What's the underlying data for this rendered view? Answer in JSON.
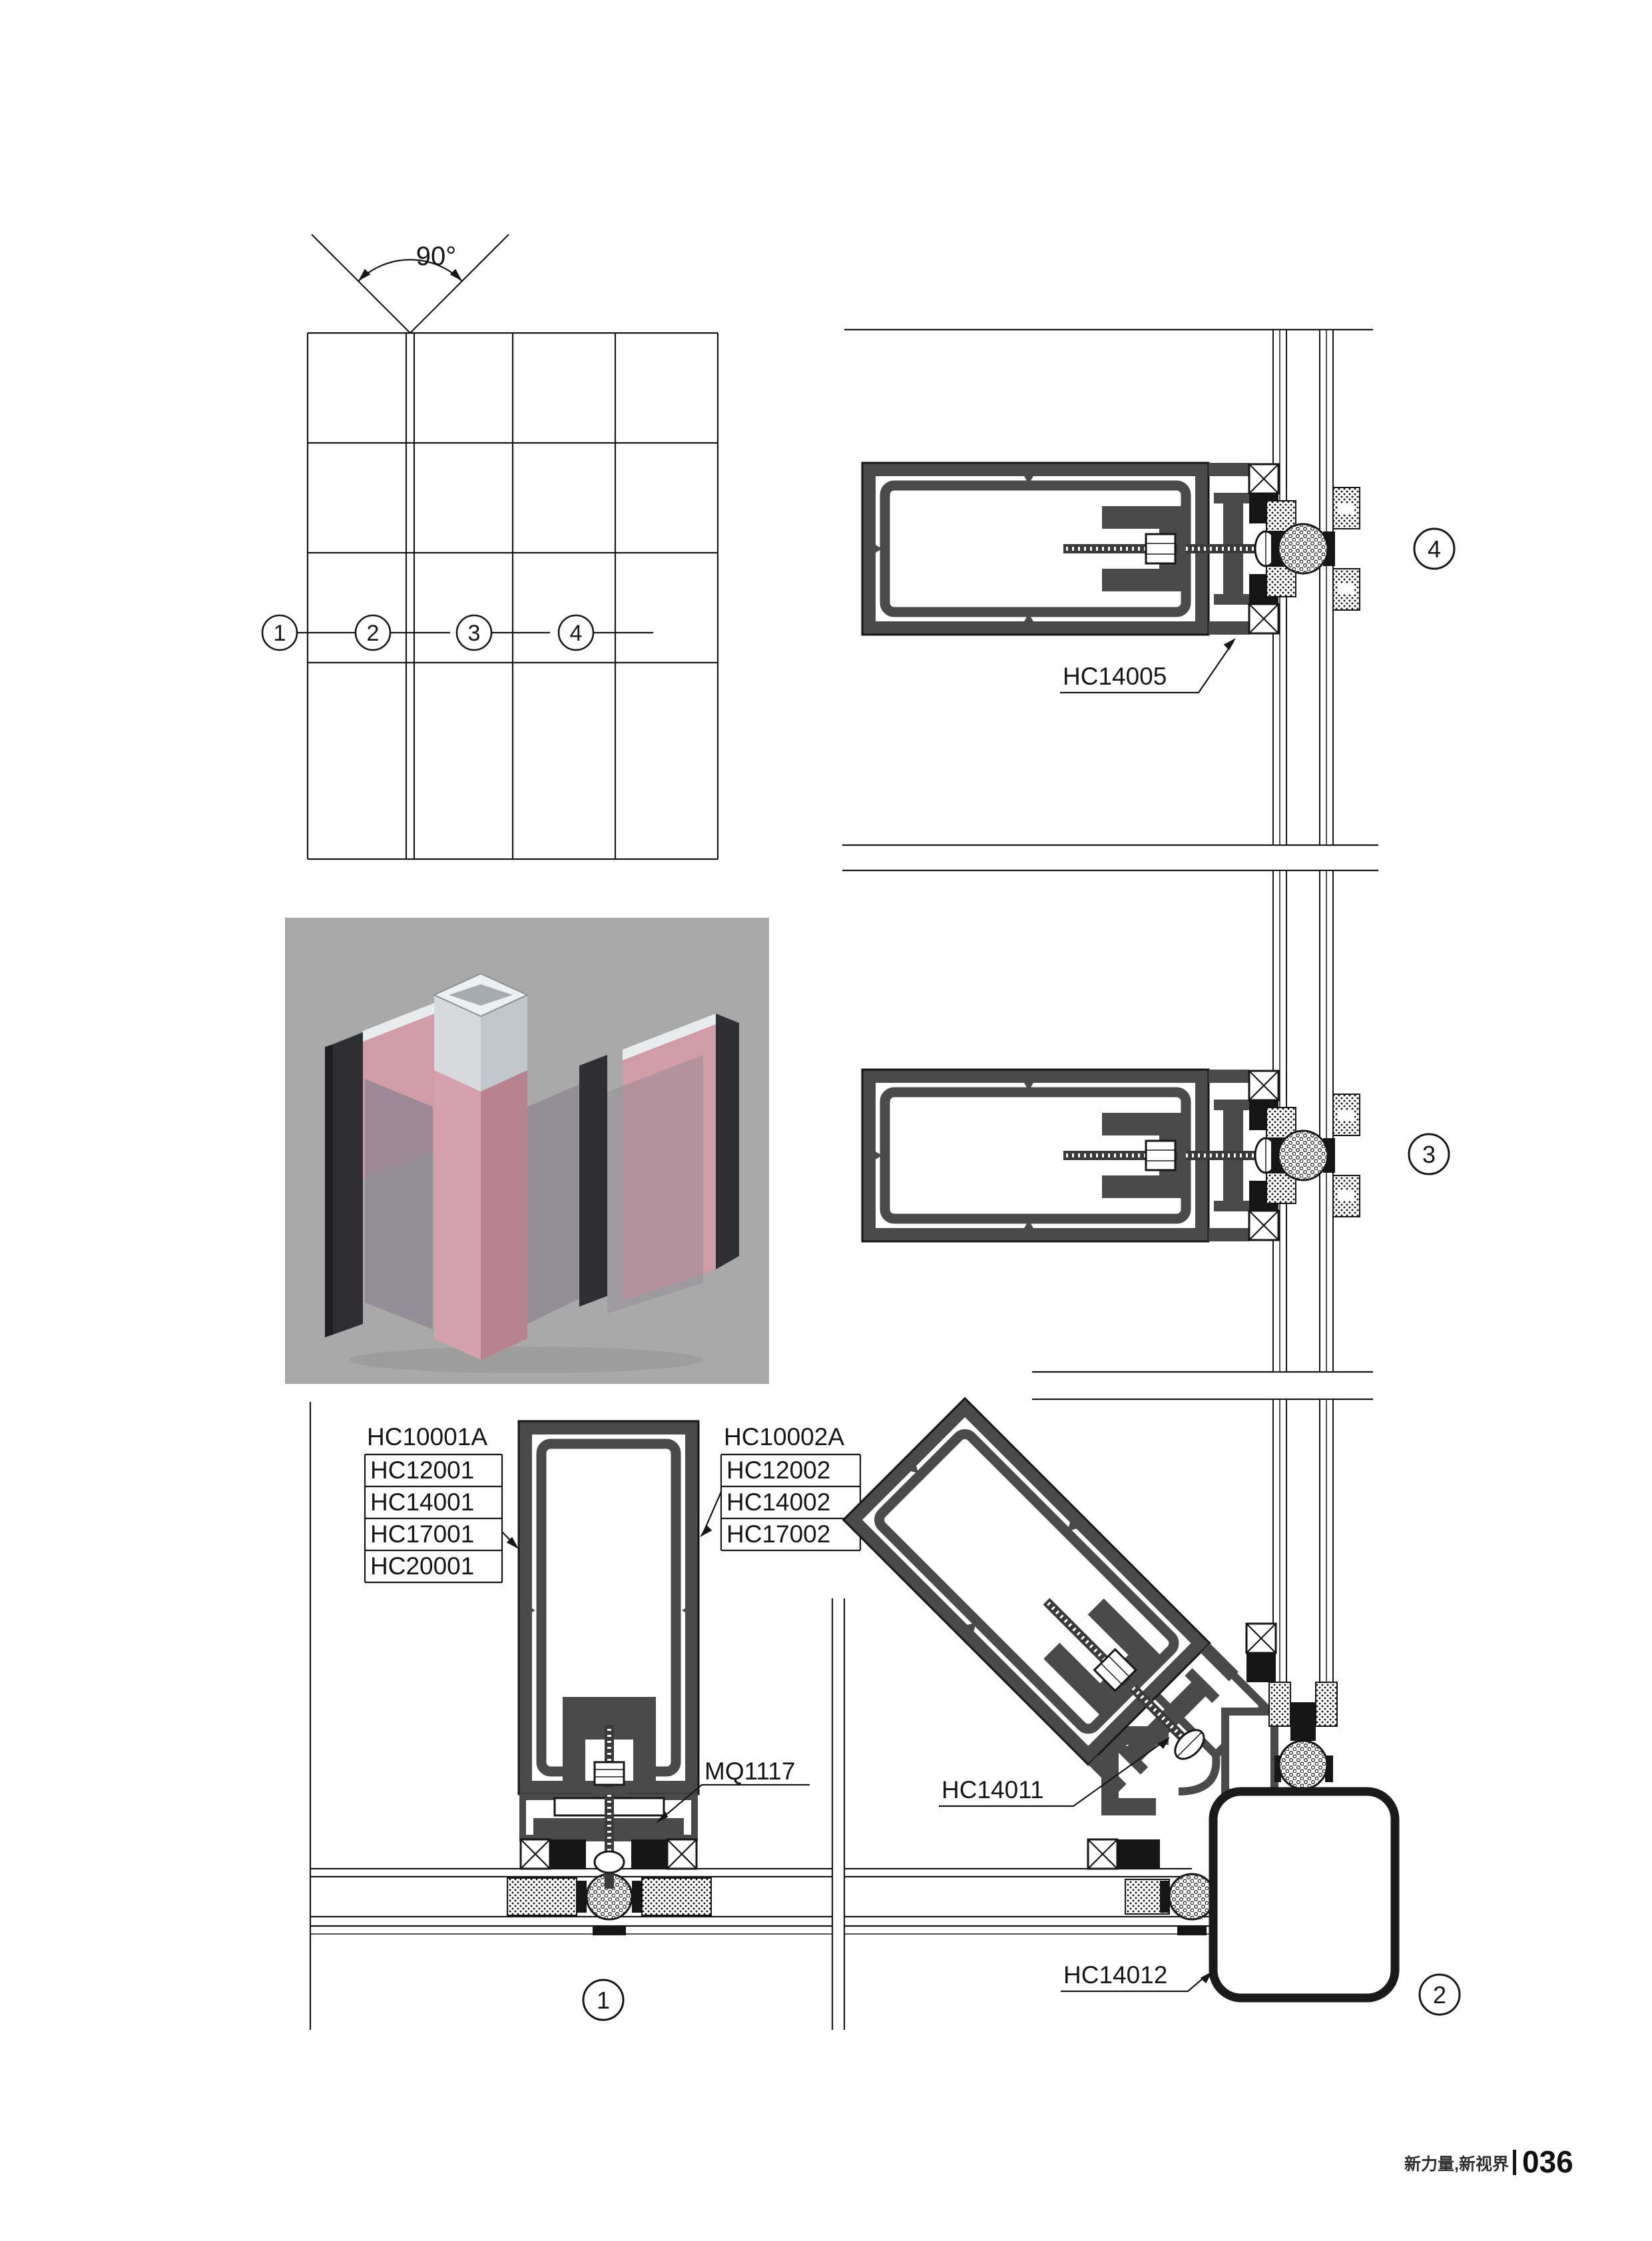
{
  "page": {
    "footer": {
      "brand": "新力量,新视界",
      "page_number": "036"
    }
  },
  "colors": {
    "line": "#161616",
    "profile_fill": "#4a4a4a",
    "render_background": "#a9a9a9",
    "profile_pink": "#d09ca8",
    "mullion_dark": "#2e2e33",
    "aluminum": "#e9eced"
  },
  "schematic": {
    "angle_label": "90°",
    "callouts": {
      "c1": "1",
      "c2": "2",
      "c3": "3",
      "c4": "4"
    }
  },
  "detail1": {
    "callout_number": "1",
    "left_labels": [
      "HC10001A",
      "HC12001",
      "HC14001",
      "HC17001",
      "HC20001"
    ],
    "right_labels": [
      "HC10002A",
      "HC12002",
      "HC14002",
      "HC17002"
    ],
    "clamp_label": "MQ1117"
  },
  "detail2": {
    "callout_number": "2",
    "adapter_label": "HC14011",
    "corner_label": "HC14012"
  },
  "detail3": {
    "callout_number": "3"
  },
  "detail4": {
    "callout_number": "4",
    "connector_label": "HC14005"
  }
}
